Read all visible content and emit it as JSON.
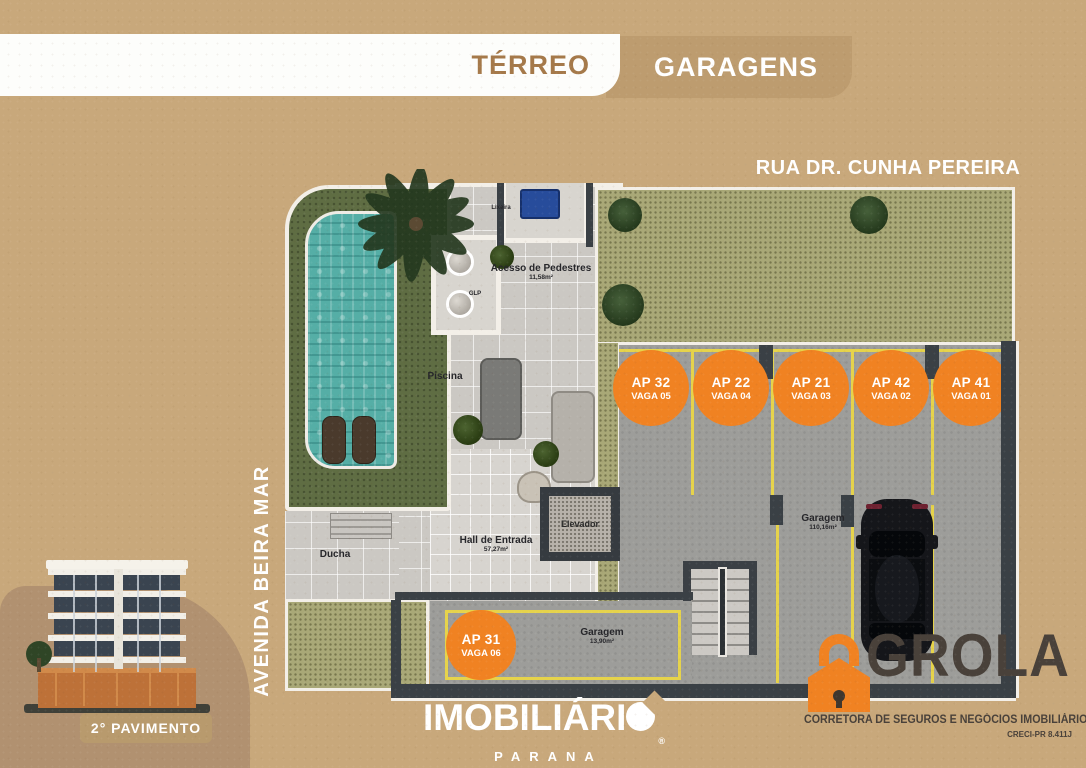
{
  "header": {
    "tab_terreo": "TÉRREO",
    "tab_garagens": "GARAGENS"
  },
  "streets": {
    "top": "RUA DR. CUNHA PEREIRA",
    "left": "AVENIDA BEIRA MAR"
  },
  "plan": {
    "labels": {
      "piscina": "Piscina",
      "acesso": "Acesso de Pedestres",
      "acesso_area": "11,58m²",
      "hall": "Hall de Entrada",
      "hall_area": "57,27m²",
      "elevador": "Elevador",
      "ducha": "Ducha",
      "glp": "GLP",
      "lixeira": "Lixeira",
      "garagem_main": "Garagem",
      "garagem_main_area": "110,16m²",
      "garagem_small": "Garagem",
      "garagem_small_area": "13,90m²"
    },
    "parking_spots": [
      {
        "ap": "AP 32",
        "vaga": "VAGA 05"
      },
      {
        "ap": "AP 22",
        "vaga": "VAGA 04"
      },
      {
        "ap": "AP 21",
        "vaga": "VAGA 03"
      },
      {
        "ap": "AP 42",
        "vaga": "VAGA 02"
      },
      {
        "ap": "AP 41",
        "vaga": "VAGA 01"
      },
      {
        "ap": "AP 31",
        "vaga": "VAGA 06"
      }
    ]
  },
  "building_card": {
    "caption": "2° PAVIMENTO"
  },
  "footer": {
    "brand_prefix": "IMOBILIÁRI",
    "brand_registered": "®",
    "brand_sub": "PARANA",
    "grola_name": "GROLA",
    "grola_tagline": "CORRETORA DE SEGUROS E NEGÓCIOS IMOBILIÁRIOS",
    "grola_creci": "CRECI-PR 8.411J"
  },
  "colors": {
    "background_tan": "#c8a87b",
    "tab_tan": "#bd9c6f",
    "terreo_brown": "#a5794a",
    "accent_orange": "#f08222",
    "stall_yellow": "#e6d34b",
    "wall_dark": "#3a4045",
    "pool_teal": "#55aea6",
    "grass_olive": "#a9a877",
    "grola_brown": "#49413a"
  }
}
